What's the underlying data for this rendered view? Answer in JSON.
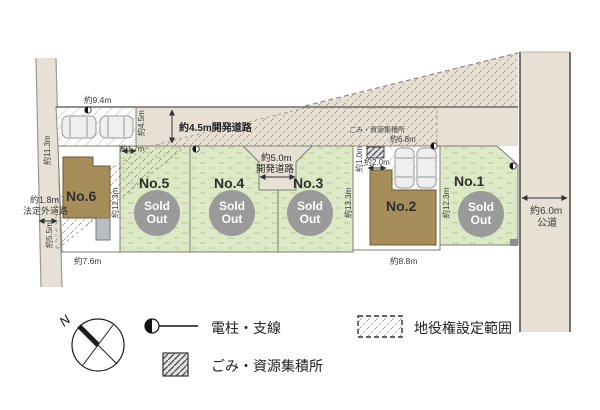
{
  "plan": {
    "lots": {
      "no1": {
        "label": "No.1"
      },
      "no2": {
        "label": "No.2"
      },
      "no3": {
        "label": "No.3"
      },
      "no4": {
        "label": "No.4"
      },
      "no5": {
        "label": "No.5"
      },
      "no6": {
        "label": "No.6"
      }
    },
    "sold": {
      "line1": "Sold",
      "line2": "Out"
    },
    "roads": {
      "top_road": "約4.5m開発道路",
      "mid_road_width": "約5.0m",
      "mid_road_name": "開発道路",
      "left_road_width": "約1.8m",
      "left_road_name": "法定外道路",
      "right_road_width": "約6.0m",
      "right_road_name": "公道"
    },
    "dims": {
      "d94": "約9.4m",
      "d113": "約11.3m",
      "d45": "約4.5m",
      "d17": "約1.7m",
      "d55": "約5.5m",
      "d76": "約7.6m",
      "d123a": "約12.3m",
      "d133": "約13.3m",
      "d10": "約1.0m",
      "d20": "約2.0m",
      "d68": "約6.8m",
      "d123b": "約12.3m",
      "d88": "約8.8m"
    },
    "gomi_label": "ごみ・資源集積所"
  },
  "legend": {
    "compass_label": "N",
    "items": [
      {
        "icon": "utility-pole-icon",
        "label": "電柱・支線"
      },
      {
        "icon": "garbage-collection-icon",
        "label": "ごみ・資源集積所"
      },
      {
        "icon": "easement-range-icon",
        "label": "地役権設定範囲"
      }
    ]
  },
  "colors": {
    "road_beige": "#e6e1d4",
    "lot_green": "#dce8c6",
    "building_brown": "#a78d5a",
    "sold_gray": "#9a9a9a"
  }
}
